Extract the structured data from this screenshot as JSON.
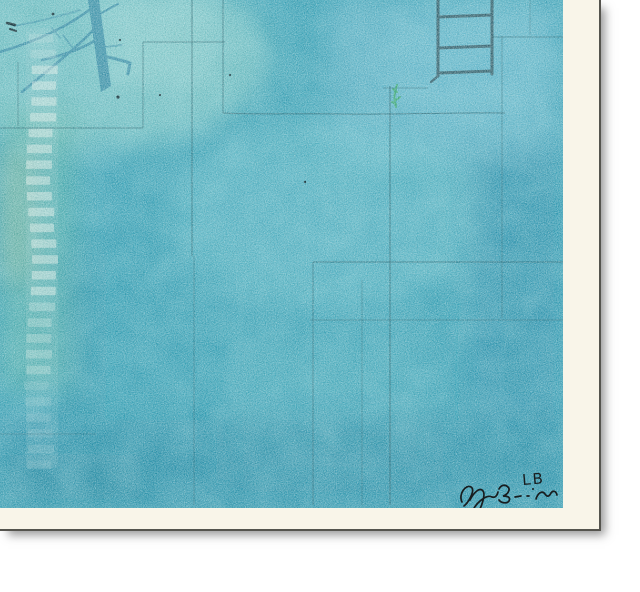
{
  "artwork": {
    "signature_initials": "LB"
  },
  "left_ladder": {
    "rung_count": 28
  },
  "palette": {
    "background": "#ffffff",
    "mat": "#f9f5e9",
    "frame_line": "#55544e",
    "shadow": "rgba(70,70,70,0.55)",
    "painting_base": "#2f9cb2",
    "light_topleft": "#7cc7c5",
    "mint_patch": "#8fd0cd",
    "steel_topright": "#5fb3c9",
    "center_light": "#63bdca",
    "green_left": "#57b3a2",
    "yellow_green": "#a8c493",
    "scratch_light": "#4fb0bd",
    "deep_bottom": "#157f9e",
    "deep_right": "#2387a9",
    "deep_corner": "#1a86a0",
    "topright_glow": "#66b9cd",
    "sketch_line": "#16505c",
    "dark_ladder": "#2a535e",
    "tree": "#338ba5",
    "pale_ladder": "#dfeee8",
    "green_sprig": "#2ea55e",
    "ink_speck": "#0e2d35",
    "signature_ink": "#181d1f"
  }
}
